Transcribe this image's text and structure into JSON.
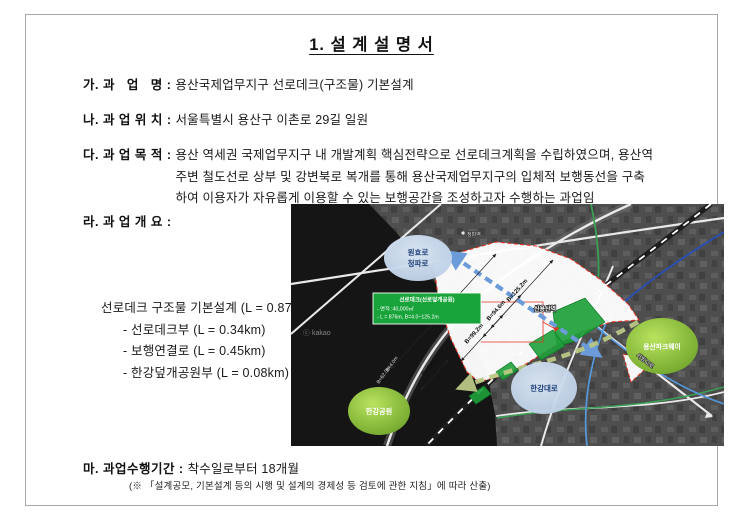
{
  "doc": {
    "title": "1. 설 계 설 명 서",
    "item_a": {
      "label": "가. 과   업   명 : ",
      "text": "용산국제업무지구 선로데크(구조물) 기본설계"
    },
    "item_b": {
      "label": "나. 과 업 위 치 : ",
      "text": "서울특별시 용산구 이촌로 29길 일원"
    },
    "item_c": {
      "label": "다. 과 업 목 적 : ",
      "line1": "용산 역세권 국제업무지구 내 개발계획 핵심전략으로 선로데크계획을 수립하였으며, 용산역",
      "line2": "주변 철도선로 상부 및 강변북로 복개를 통해 용산국제업무지구의 입체적 보행동선을 구축",
      "line3": "하여 이용자가 자유롭게 이용할 수 있는 보행공간을 조성하고자 수행하는 과업임"
    },
    "item_d": {
      "label": "라. 과 업 개 요 : "
    },
    "overview": {
      "title": "선로데크 구조물 기본설계 (L = 0.87km)",
      "item1": "- 선로데크부 (L = 0.34km)",
      "item2": "- 보행연결로 (L = 0.45km)",
      "item3": "- 한강덮개공원부 (L = 0.08km)"
    },
    "item_e": {
      "label": "마. 과업수행기간 : ",
      "text": "착수일로부터 18개월",
      "note": "(※ 「설계공모, 기본설계 등의 시행 및 설계의 경제성 등 검토에 관한 지침」에 따라 산출)"
    }
  },
  "map": {
    "infobox": {
      "title": "선로데크(선로덮개공원)",
      "area": "- 면적 :40,000㎡",
      "length": "- L = 876m, B=4.0~125.2m"
    },
    "bubbles": {
      "wonhyo_line1": "원효로",
      "wonhyo_line2": "청파로",
      "hangang_daero": "한강대로",
      "yongsan_parkway": "용산파크웨이",
      "hangang_park": "한강공원"
    },
    "stations": {
      "sinyongsan": "신용산역",
      "cheongpa": "청파역"
    },
    "roads": {
      "seobinggo": "서빙고로"
    },
    "dims": {
      "l876": "L=876m",
      "b8": "B=8.0m",
      "b99": "B=99.2m",
      "b94": "B=94.6m",
      "b125": "B=125.2m",
      "b4": "B=4.0m",
      "b62": "B=62.0m"
    },
    "watermark": "ⓒ kakao"
  },
  "colors": {
    "accent_green": "#18a43a",
    "boundary_red": "#e23222",
    "arrow_blue": "#6b9bd8",
    "arrow_green": "#b9c885",
    "bubble_blue": "#c9d9ec",
    "ellipse_green": "#76ad2e"
  }
}
